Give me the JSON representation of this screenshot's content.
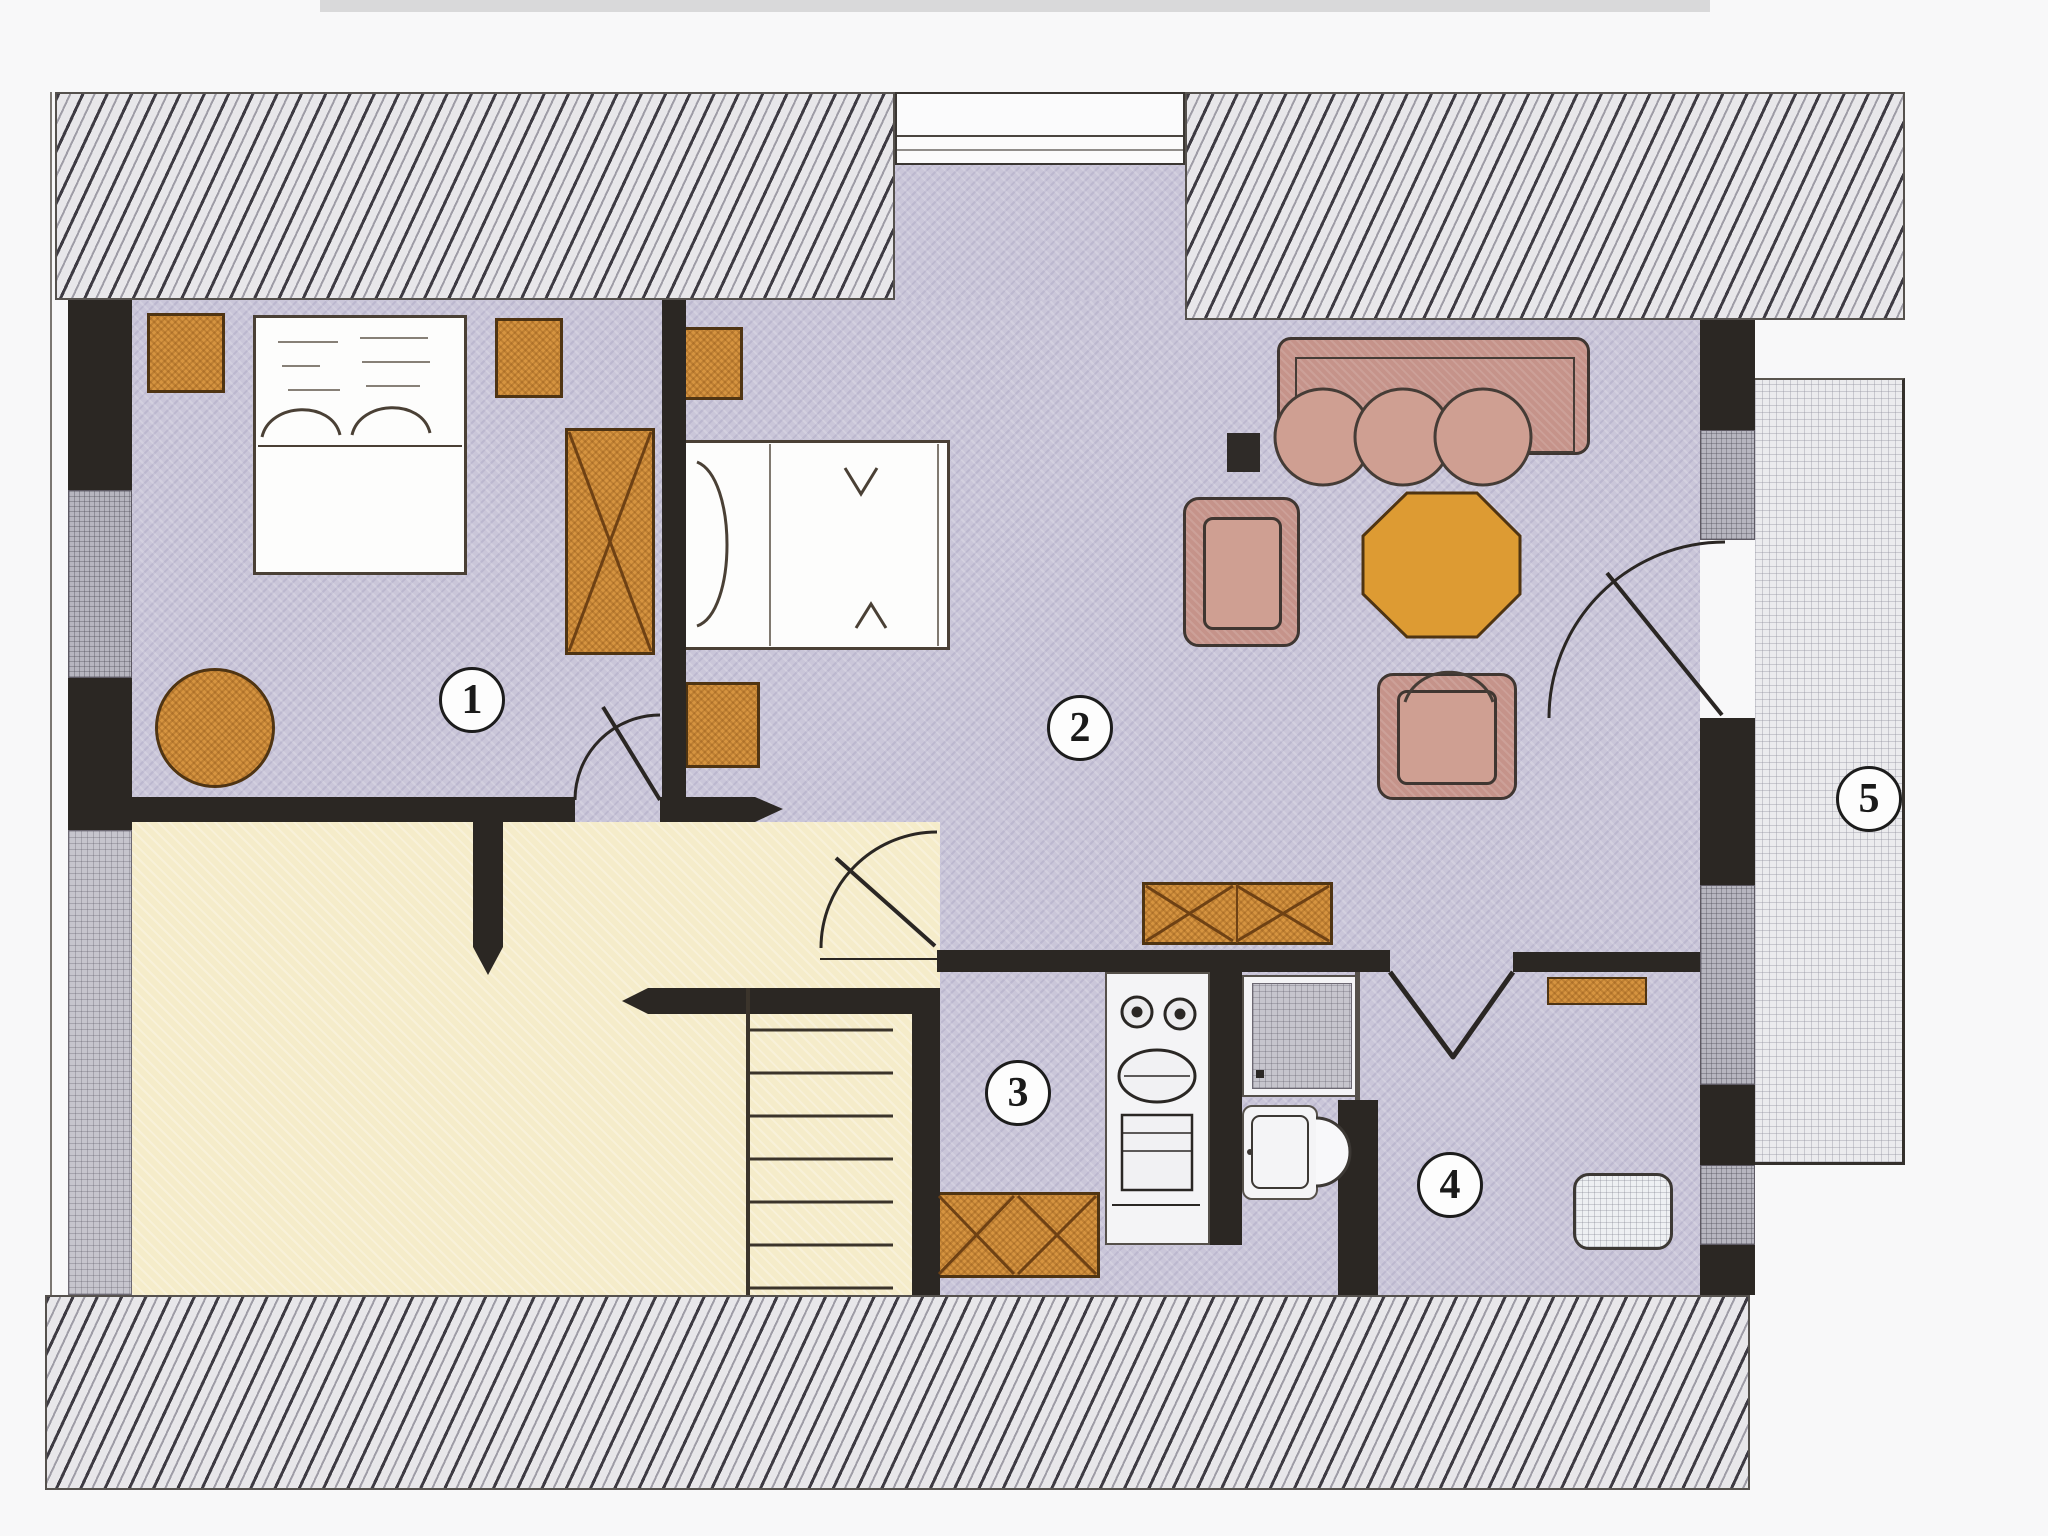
{
  "floorplan": {
    "room_labels": [
      "1",
      "2",
      "3",
      "4",
      "5"
    ],
    "colors": {
      "floor": "#cac6d9",
      "cream": "#f5ecca",
      "balcony": "#ebebee",
      "wall": "#2b2723",
      "graywall": "#b6b5bf",
      "graywall2": "#c6c5cd",
      "orange": "#d69440",
      "mauve": "#c5938a",
      "hatch": "#e8e7ea"
    }
  }
}
